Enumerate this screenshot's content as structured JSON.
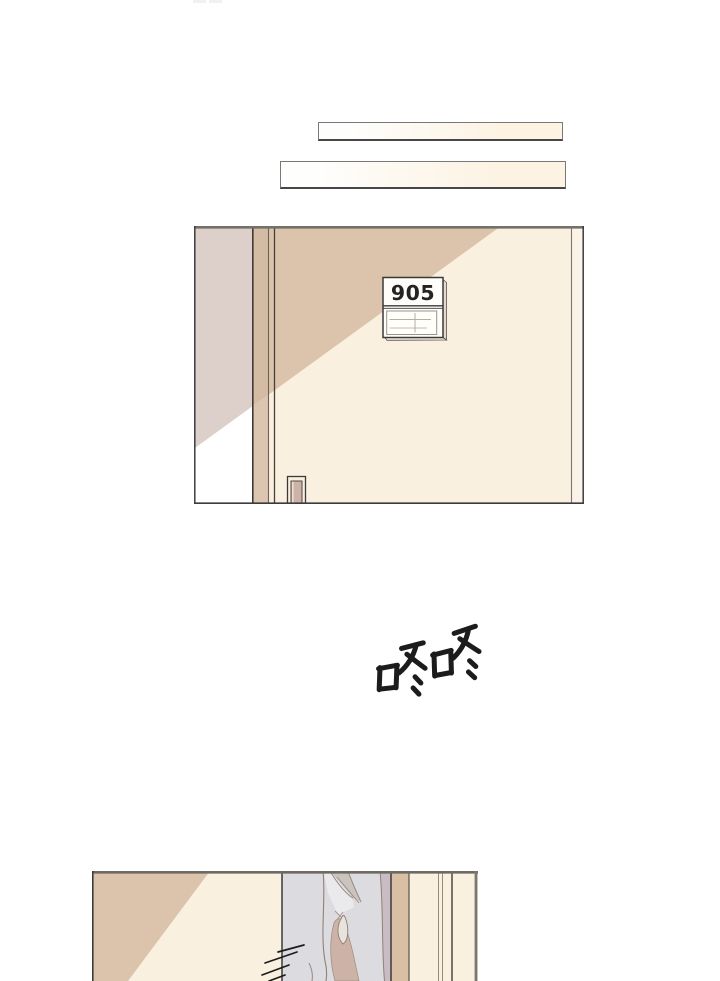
{
  "door_sign": {
    "number": "905"
  },
  "sfx": {
    "text": "咚咚"
  },
  "colors": {
    "ink": "#1c1c1c",
    "cream": "#faf0e0",
    "cream_light": "#fbf3e8",
    "wall_tan": "#dcc3ac",
    "strip_tan": "#d4bba4",
    "strip_tan_light": "#dcc6b2",
    "hall_pink": "#ddcfc9",
    "below_light": "#ffffff",
    "doorway_gray": "#dcdbdf",
    "curtain_fabric": "#cdb3a7",
    "curtain_fold": "#cbc3be",
    "curtain_highlight": "#e9e3de",
    "mauve": "#c9bcc3",
    "tan_deep": "#d9bfa4",
    "sign_bg": "#fefdf9",
    "sign_text": "#232323"
  }
}
